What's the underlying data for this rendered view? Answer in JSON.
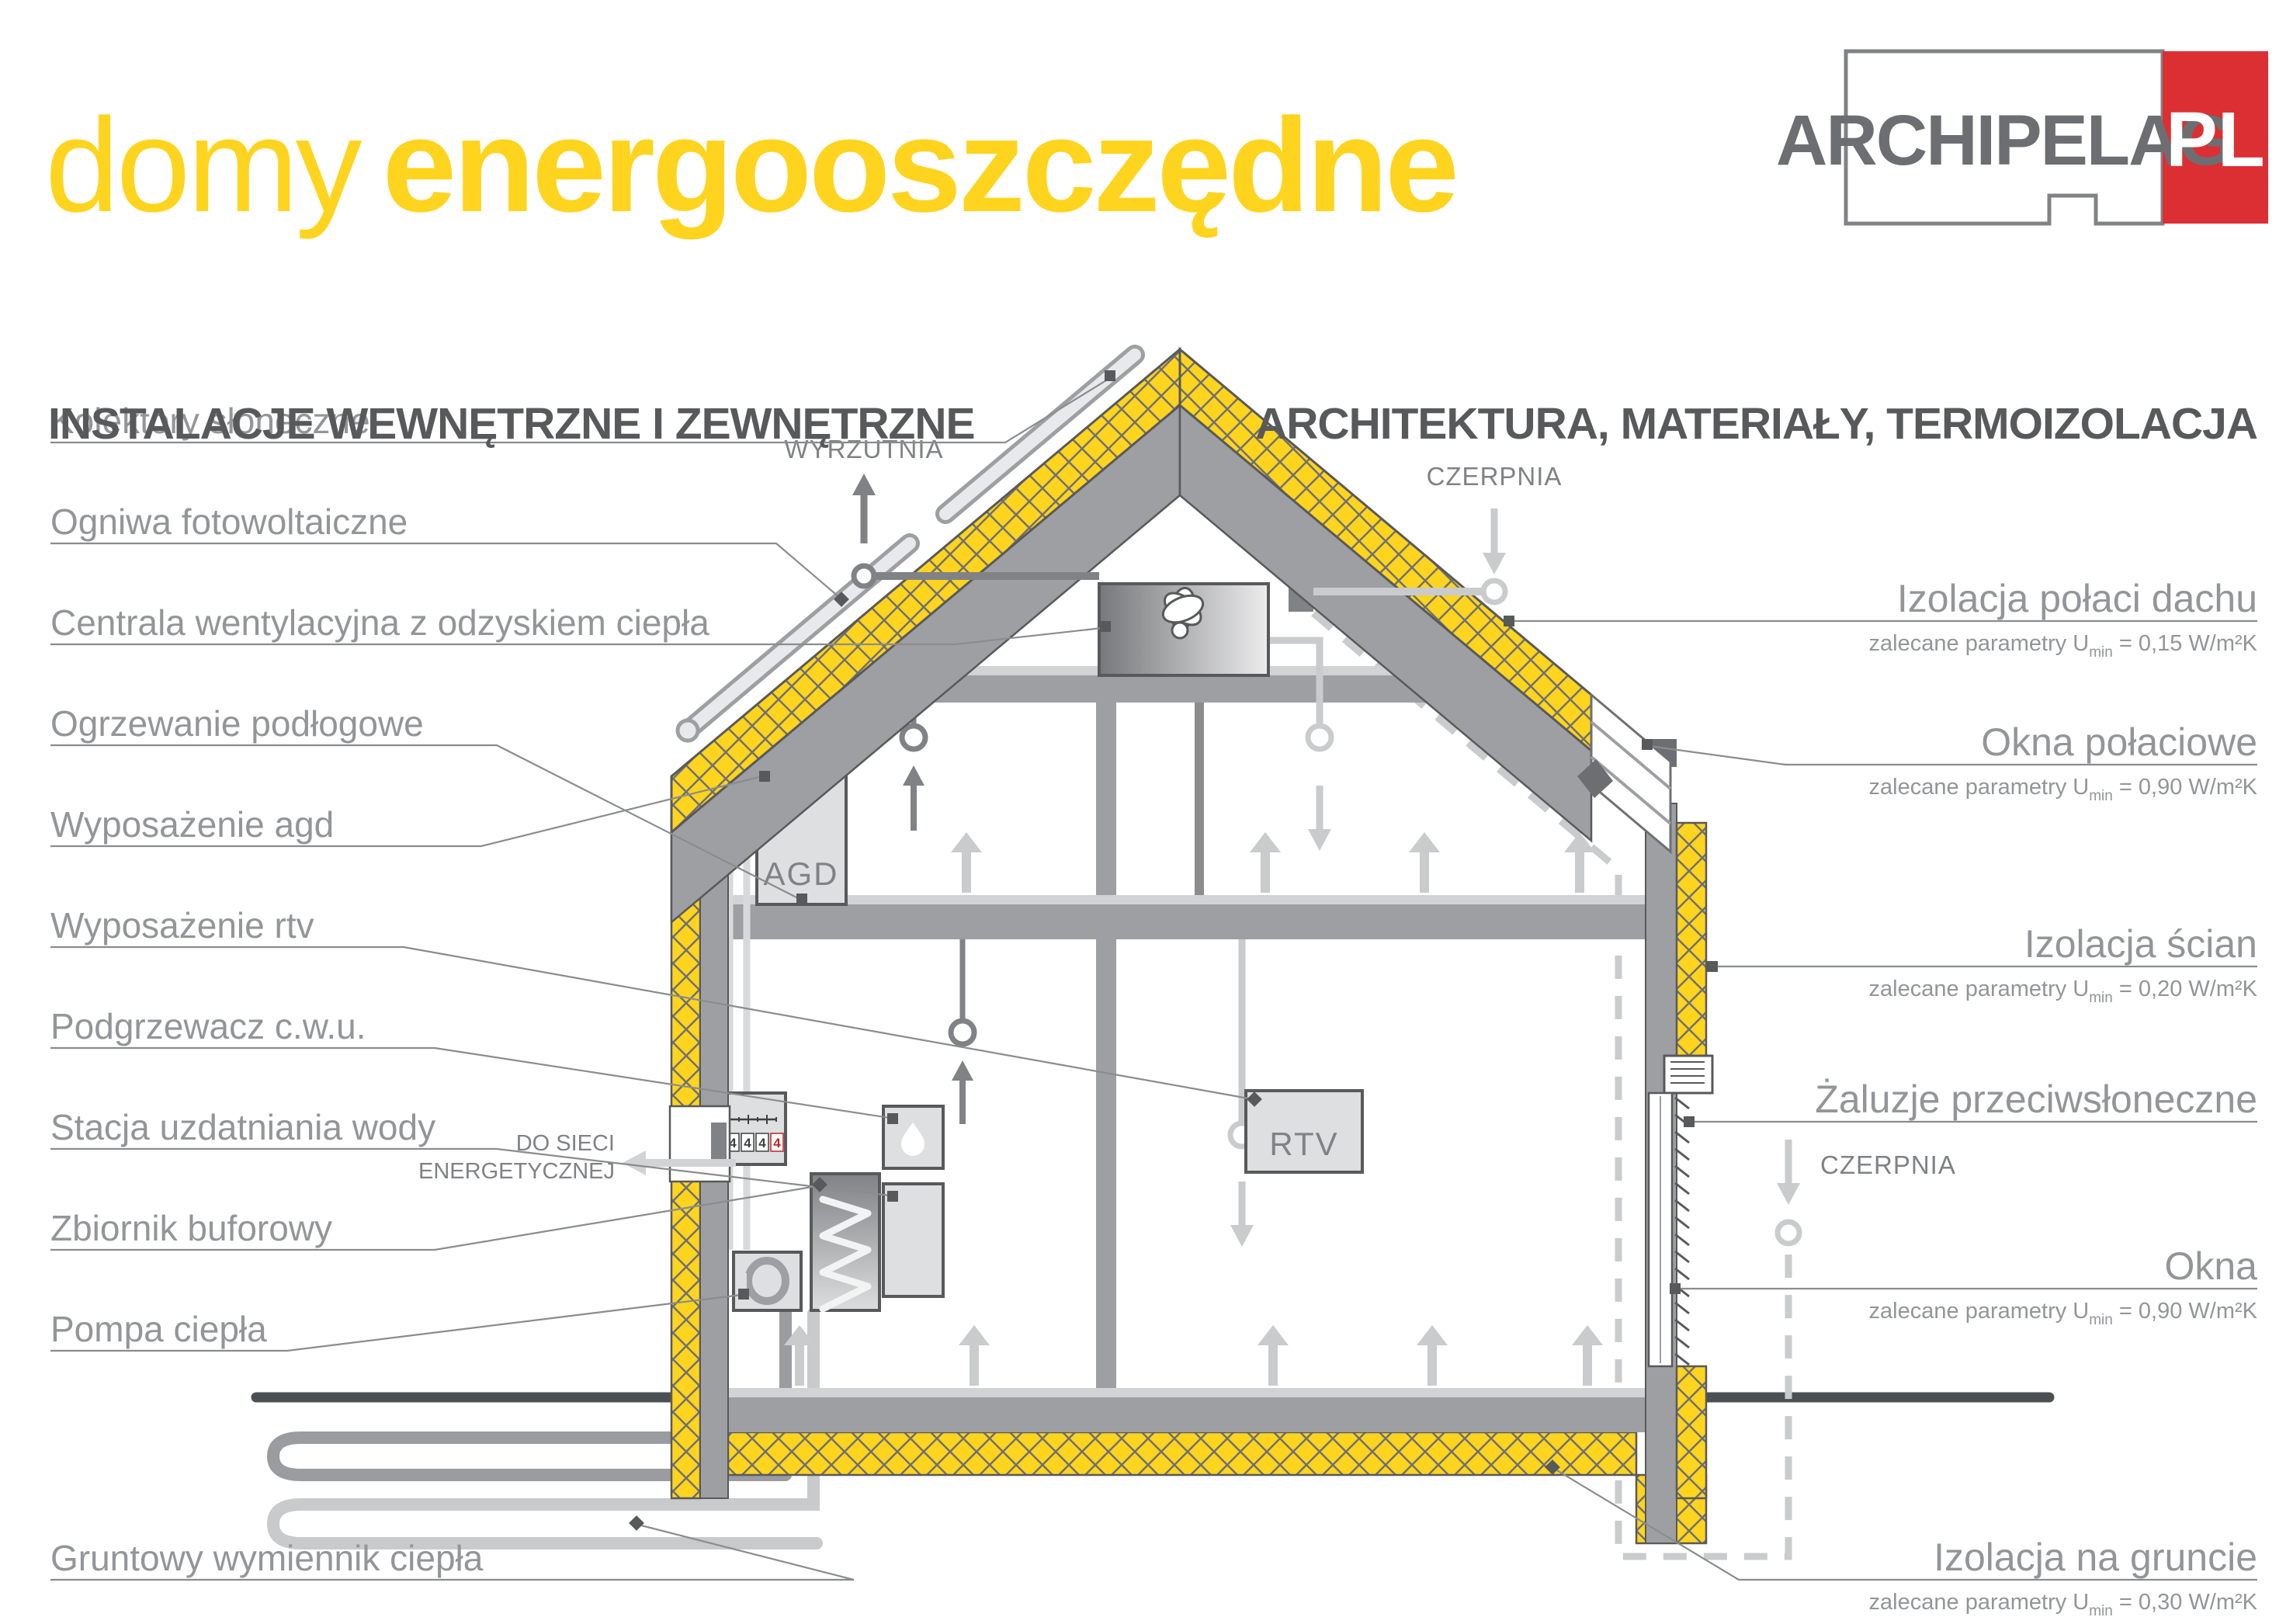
{
  "title": {
    "light": "domy",
    "bold": "energooszczędne"
  },
  "logo": {
    "name": "ARCHIPELAG",
    "tld": "PL"
  },
  "sections": {
    "left": "INSTALACJE WEWNĘTRZNE I ZEWNĘTRZNE",
    "right": "ARCHITEKTURA, MATERIAŁY, TERMOIZOLACJA"
  },
  "left_labels": [
    {
      "label": "Kolektory słoneczne"
    },
    {
      "label": "Ogniwa fotowoltaiczne"
    },
    {
      "label": "Centrala wentylacyjna z odzyskiem ciepła"
    },
    {
      "label": "Ogrzewanie podłogowe"
    },
    {
      "label": "Wyposażenie agd"
    },
    {
      "label": "Wyposażenie rtv"
    },
    {
      "label": "Podgrzewacz c.w.u."
    },
    {
      "label": "Stacja uzdatniania wody"
    },
    {
      "label": "Zbiornik buforowy"
    },
    {
      "label": "Pompa ciepła"
    },
    {
      "label": "Gruntowy wymiennik ciepła"
    }
  ],
  "right_labels": [
    {
      "label": "Izolacja połaci dachu",
      "param_pre": "zalecane parametry U",
      "param_sub": "min",
      "param_rest": " = 0,15 W/m²K"
    },
    {
      "label": "Okna połaciowe",
      "param_pre": "zalecane parametry U",
      "param_sub": "min",
      "param_rest": " = 0,90 W/m²K"
    },
    {
      "label": "Izolacja ścian",
      "param_pre": "zalecane parametry U",
      "param_sub": "min",
      "param_rest": " = 0,20 W/m²K"
    },
    {
      "label": "Żaluzje przeciwsłoneczne",
      "param_pre": "",
      "param_sub": "",
      "param_rest": ""
    },
    {
      "label": "Okna",
      "param_pre": "zalecane parametry U",
      "param_sub": "min",
      "param_rest": " = 0,90 W/m²K"
    },
    {
      "label": "Izolacja na gruncie",
      "param_pre": "zalecane parametry U",
      "param_sub": "min",
      "param_rest": " = 0,30 W/m²K"
    }
  ],
  "annotations": {
    "wyrzutnia": "WYRZUTNIA",
    "czerpnia_roof": "CZERPNIA",
    "czerpnia_ground": "CZERPNIA",
    "grid_line1": "DO SIECI",
    "grid_line2": "ENERGETYCZNEJ",
    "agd": "AGD",
    "rtv": "RTV"
  },
  "meter": {
    "digits": [
      "4",
      "4",
      "4",
      "4"
    ]
  },
  "colors": {
    "accent_yellow": "#FFD41F",
    "brand_red": "#DC2F34",
    "header_dark": "#58595B",
    "label_gray": "#939598",
    "structure_gray": "#9D9FA2",
    "duct_light_gray": "#C9CBCD",
    "ground_dark": "#4A5054"
  }
}
